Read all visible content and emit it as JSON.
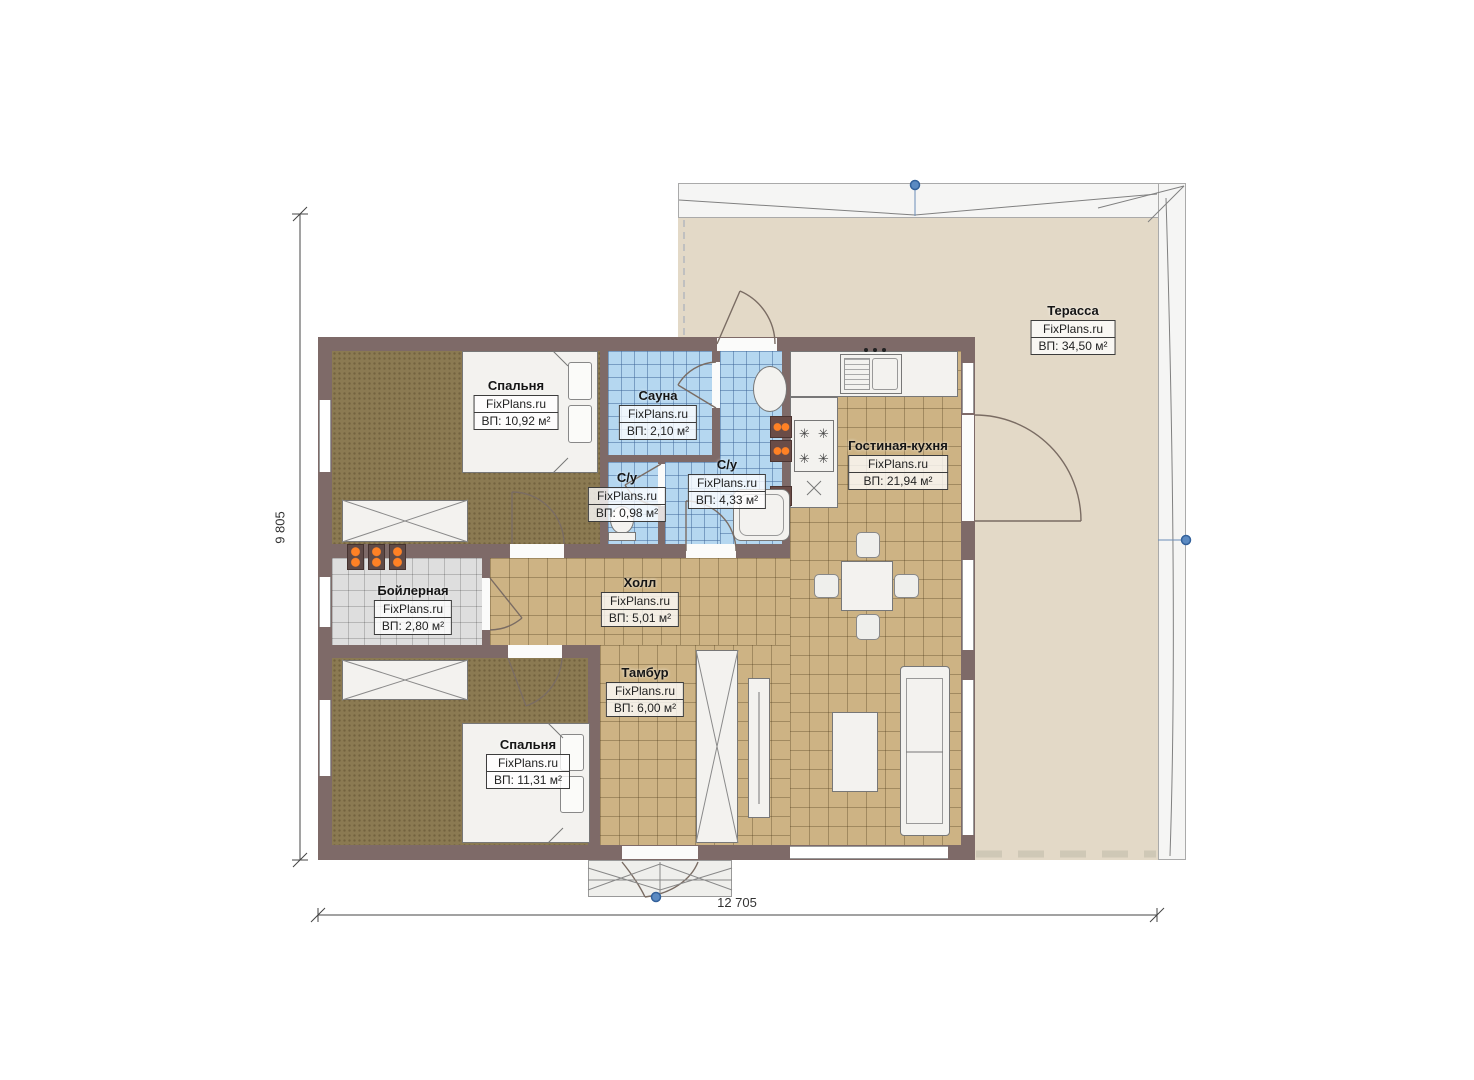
{
  "plan": {
    "brand": "FixPlans.ru",
    "rooms": [
      {
        "name": "Спальня",
        "area": "ВП: 10,92 м²"
      },
      {
        "name": "Сауна",
        "area": "ВП: 2,10 м²"
      },
      {
        "name": "С/у",
        "area": "ВП: 0,98 м²"
      },
      {
        "name": "С/у",
        "area": "ВП: 4,33 м²"
      },
      {
        "name": "Гостиная-кухня",
        "area": "ВП: 21,94 м²"
      },
      {
        "name": "Бойлерная",
        "area": "ВП: 2,80 м²"
      },
      {
        "name": "Холл",
        "area": "ВП: 5,01 м²"
      },
      {
        "name": "Тамбур",
        "area": "ВП: 6,00 м²"
      },
      {
        "name": "Спальня",
        "area": "ВП: 11,31 м²"
      },
      {
        "name": "Терасса",
        "area": "ВП: 34,50 м²"
      }
    ],
    "dimensions": {
      "width": "12 705",
      "height": "9 805"
    },
    "colors": {
      "wall": "#7e6a68",
      "carpet": "#8b7a52",
      "tile_tan": "#cdb384",
      "tile_blue": "#b5d7f0",
      "tile_gray": "#dedede",
      "terrace": "#e3d9c7",
      "heater_orange": "#ff8125",
      "marker_blue": "#5b8ac2"
    }
  }
}
